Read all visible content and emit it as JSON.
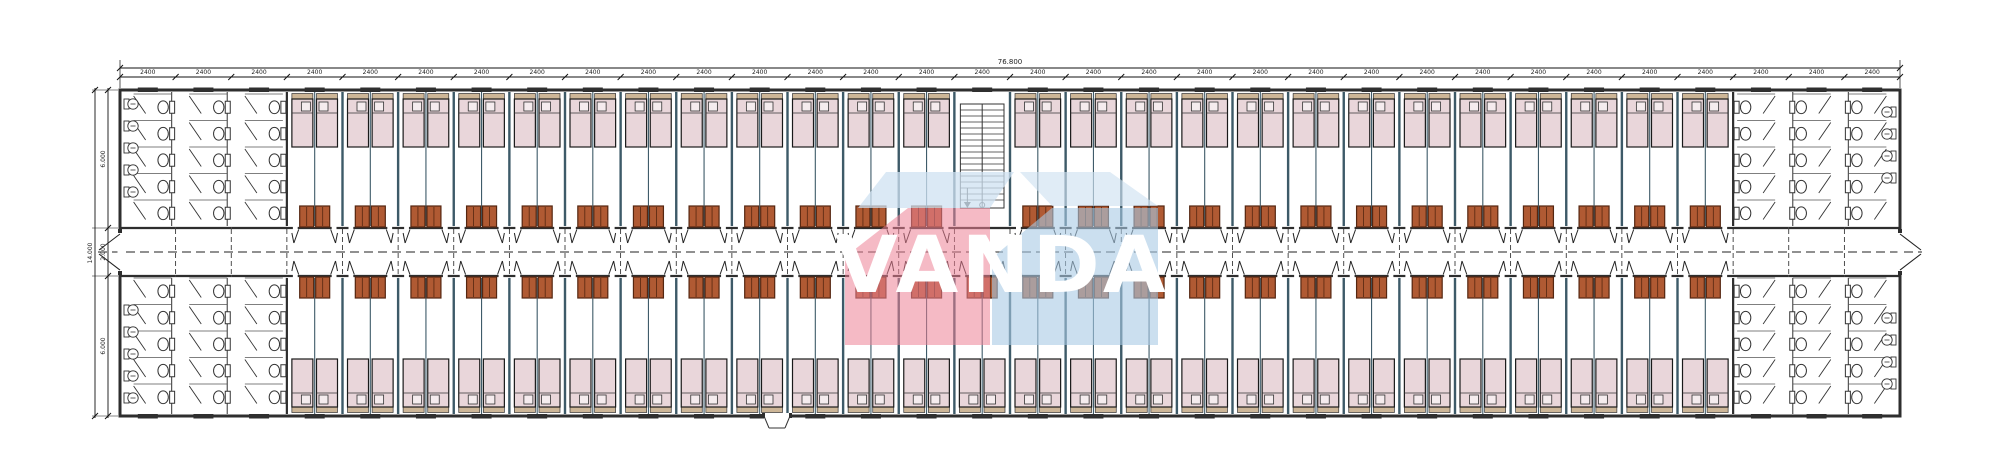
{
  "drawing": {
    "kind": "dormitory-floor-plan",
    "dimensions": {
      "total_width_label": "76.800",
      "module_width_label": "2400",
      "module_count": 32,
      "left_total_label": "14.000",
      "left_segment_labels": [
        "6.000",
        "2.000",
        "6.000"
      ]
    },
    "watermark": {
      "text": "VANDA",
      "pink": "#ec8196",
      "blue": "#a9c9e5",
      "pale_blue": "#cfe2f1",
      "text_color": "#ffffff"
    },
    "layout": {
      "bathroom_modules_left": 3,
      "bathroom_modules_right": 3,
      "bedroom_modules": 26,
      "stair_module_index": 16,
      "beds_per_module": 2,
      "wardrobes_per_module": 2,
      "stall_columns_per_bathroom": 3,
      "stall_rows_top": 5,
      "stall_rows_bottom": 5,
      "basins_left_top": 5,
      "basins_left_bottom": 5,
      "basins_right_top": 4,
      "basins_right_bottom": 4
    },
    "colors": {
      "wall": "#2e2e2e",
      "partition": "#3d5a68",
      "bed_fill": "#e9d6da",
      "bed_border": "#1a1a1a",
      "shelf": "#cdb697",
      "pillow": "#f5ecee",
      "cabinet": "#b05a33",
      "cabinet_border": "#552610",
      "fixture": "#333333",
      "dim_text": "#222222",
      "window": "#2f2f2f"
    }
  }
}
